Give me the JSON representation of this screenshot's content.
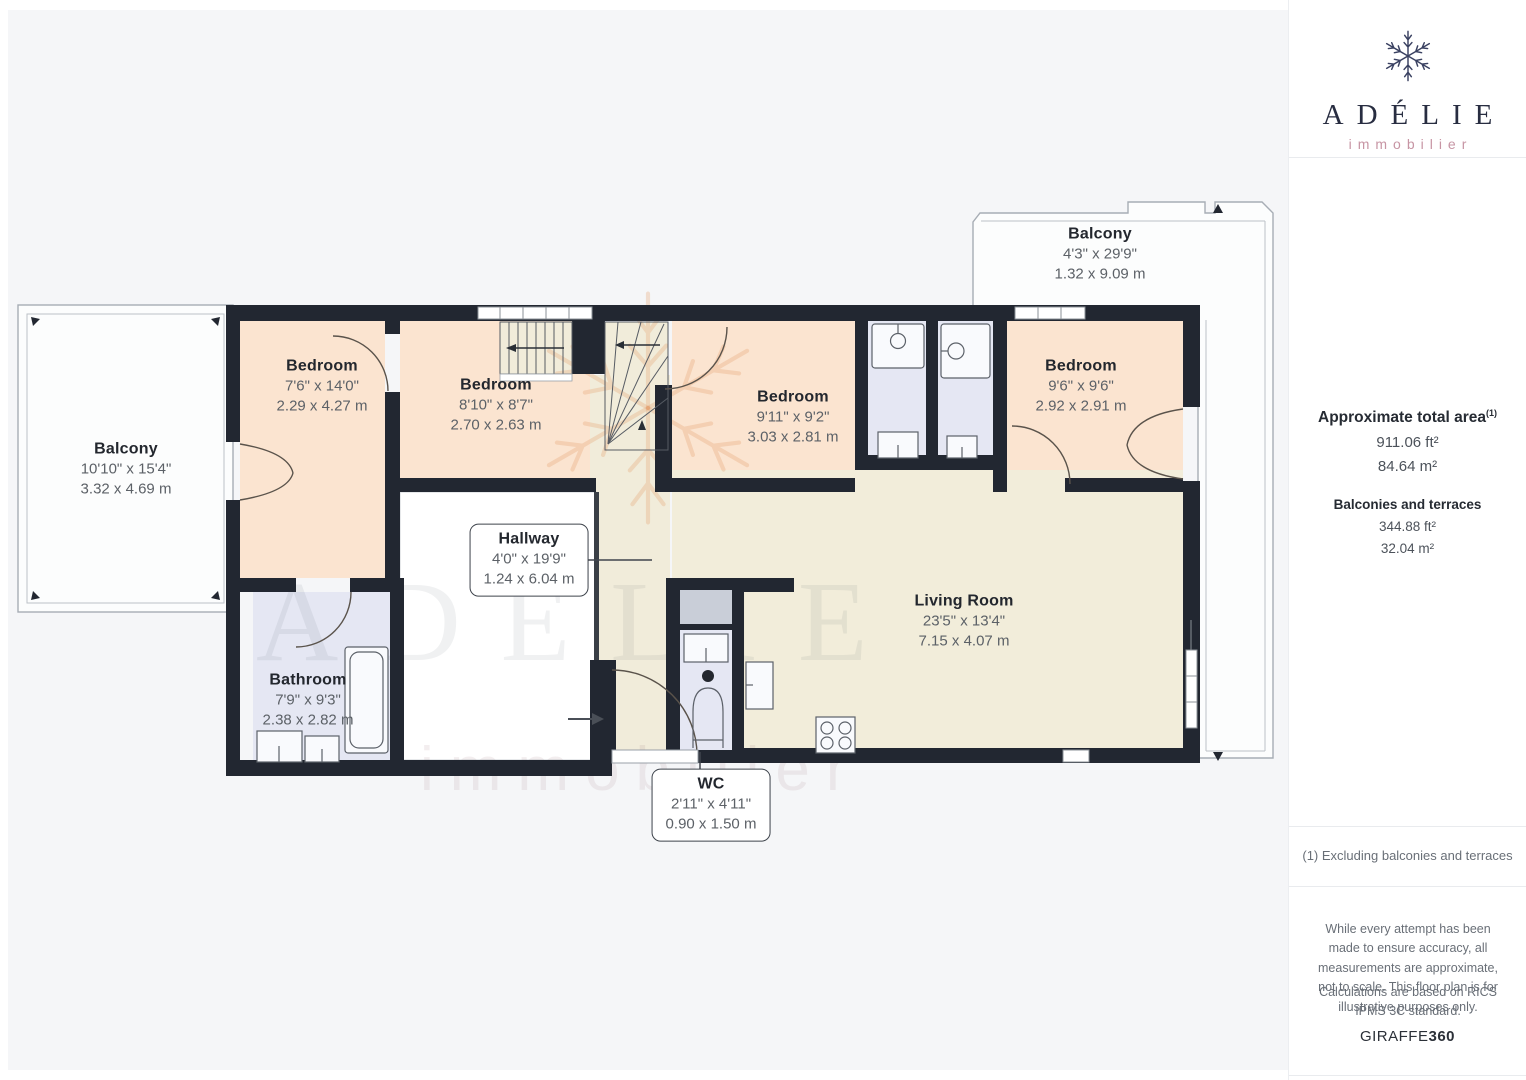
{
  "brand": {
    "name": "ADÉLIE",
    "subtitle": "immobilier"
  },
  "sidebar": {
    "total_area_title": "Approximate total area",
    "total_area_footnote_marker": "(1)",
    "total_area_ft": "911.06 ft²",
    "total_area_m": "84.64 m²",
    "balconies_title": "Balconies and terraces",
    "balconies_ft": "344.88 ft²",
    "balconies_m": "32.04 m²",
    "footnote": "(1) Excluding balconies and terraces",
    "disclaimer_1": "While every attempt has been made to ensure accuracy, all measurements are approximate, not to scale. This floor plan is for illustrative purposes only.",
    "disclaimer_2": "Calculations are based on RICS IPMS 3C standard.",
    "credit_brand": "GIRAFFE",
    "credit_brand_bold": "360"
  },
  "rooms": [
    {
      "name": "Balcony",
      "imperial": "10'10\" x 15'4\"",
      "metric": "3.32 x 4.69 m"
    },
    {
      "name": "Balcony",
      "imperial": "4'3\" x 29'9\"",
      "metric": "1.32 x 9.09 m"
    },
    {
      "name": "Bedroom",
      "imperial": "7'6\" x 14'0\"",
      "metric": "2.29 x 4.27 m"
    },
    {
      "name": "Bedroom",
      "imperial": "8'10\" x 8'7\"",
      "metric": "2.70 x 2.63 m"
    },
    {
      "name": "Bedroom",
      "imperial": "9'11\" x 9'2\"",
      "metric": "3.03 x 2.81 m"
    },
    {
      "name": "Bedroom",
      "imperial": "9'6\" x 9'6\"",
      "metric": "2.92 x 2.91 m"
    },
    {
      "name": "Hallway",
      "imperial": "4'0\" x 19'9\"",
      "metric": "1.24 x 6.04 m"
    },
    {
      "name": "Bathroom",
      "imperial": "7'9\" x 9'3\"",
      "metric": "2.38 x 2.82 m"
    },
    {
      "name": "WC",
      "imperial": "2'11\" x 4'11\"",
      "metric": "0.90 x 1.50 m"
    },
    {
      "name": "Living Room",
      "imperial": "23'5\" x 13'4\"",
      "metric": "7.15 x 4.07 m"
    }
  ]
}
